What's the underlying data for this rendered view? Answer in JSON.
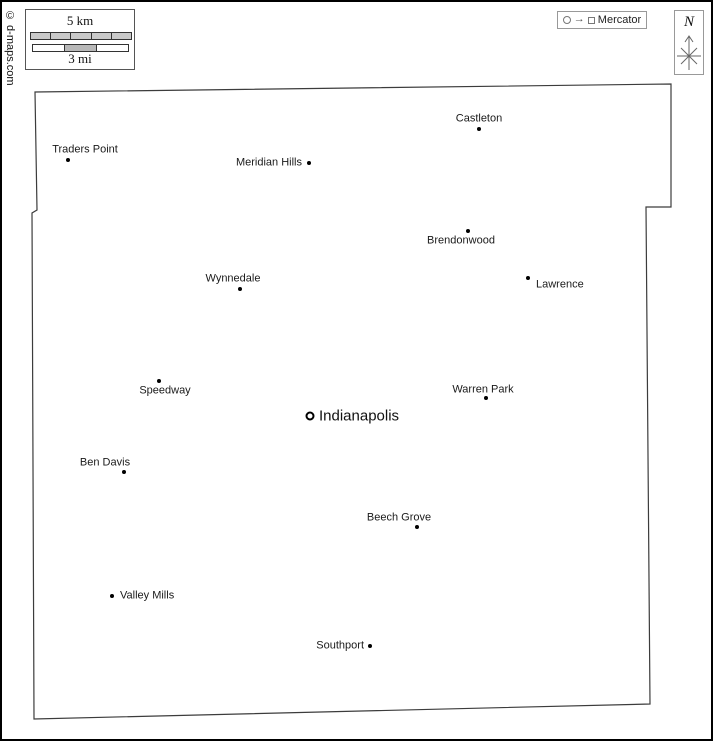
{
  "copyright": "© d-maps.com",
  "scale": {
    "km_label": "5 km",
    "mi_label": "3 mi"
  },
  "projection": {
    "label": "Mercator"
  },
  "compass": {
    "label": "N"
  },
  "colors": {
    "boundary": "#3c3c3c",
    "label_text": "#1a1a1a",
    "scale_bar_fill": "#c9c9c9",
    "frame": "#000000"
  },
  "map": {
    "boundary_points": "33,90 669,82 669,205 644,205 648,702 32,717 30,211 35,208",
    "cities": [
      {
        "name": "Castleton",
        "dot": {
          "x": 477,
          "y": 127
        },
        "label": {
          "x": 477,
          "y": 117,
          "anchor": "middle"
        },
        "capital": false
      },
      {
        "name": "Traders Point",
        "dot": {
          "x": 66,
          "y": 158
        },
        "label": {
          "x": 83,
          "y": 148,
          "anchor": "middle"
        },
        "capital": false
      },
      {
        "name": "Meridian Hills",
        "dot": {
          "x": 307,
          "y": 161
        },
        "label": {
          "x": 300,
          "y": 161,
          "anchor": "end"
        },
        "capital": false
      },
      {
        "name": "Brendonwood",
        "dot": {
          "x": 466,
          "y": 229
        },
        "label": {
          "x": 459,
          "y": 239,
          "anchor": "middle"
        },
        "capital": false
      },
      {
        "name": "Lawrence",
        "dot": {
          "x": 526,
          "y": 276
        },
        "label": {
          "x": 534,
          "y": 283,
          "anchor": "start"
        },
        "capital": false
      },
      {
        "name": "Wynnedale",
        "dot": {
          "x": 238,
          "y": 287
        },
        "label": {
          "x": 231,
          "y": 277,
          "anchor": "middle"
        },
        "capital": false
      },
      {
        "name": "Speedway",
        "dot": {
          "x": 157,
          "y": 379
        },
        "label": {
          "x": 163,
          "y": 389,
          "anchor": "middle"
        },
        "capital": false
      },
      {
        "name": "Warren Park",
        "dot": {
          "x": 484,
          "y": 396
        },
        "label": {
          "x": 481,
          "y": 388,
          "anchor": "middle"
        },
        "capital": false
      },
      {
        "name": "Indianapolis",
        "dot": {
          "x": 308,
          "y": 414
        },
        "label": {
          "x": 317,
          "y": 414,
          "anchor": "start"
        },
        "capital": true
      },
      {
        "name": "Ben Davis",
        "dot": {
          "x": 122,
          "y": 470
        },
        "label": {
          "x": 103,
          "y": 461,
          "anchor": "middle"
        },
        "capital": false
      },
      {
        "name": "Beech Grove",
        "dot": {
          "x": 415,
          "y": 525
        },
        "label": {
          "x": 397,
          "y": 516,
          "anchor": "middle"
        },
        "capital": false
      },
      {
        "name": "Valley Mills",
        "dot": {
          "x": 110,
          "y": 594
        },
        "label": {
          "x": 118,
          "y": 594,
          "anchor": "start"
        },
        "capital": false
      },
      {
        "name": "Southport",
        "dot": {
          "x": 368,
          "y": 644
        },
        "label": {
          "x": 362,
          "y": 644,
          "anchor": "end"
        },
        "capital": false
      }
    ]
  }
}
